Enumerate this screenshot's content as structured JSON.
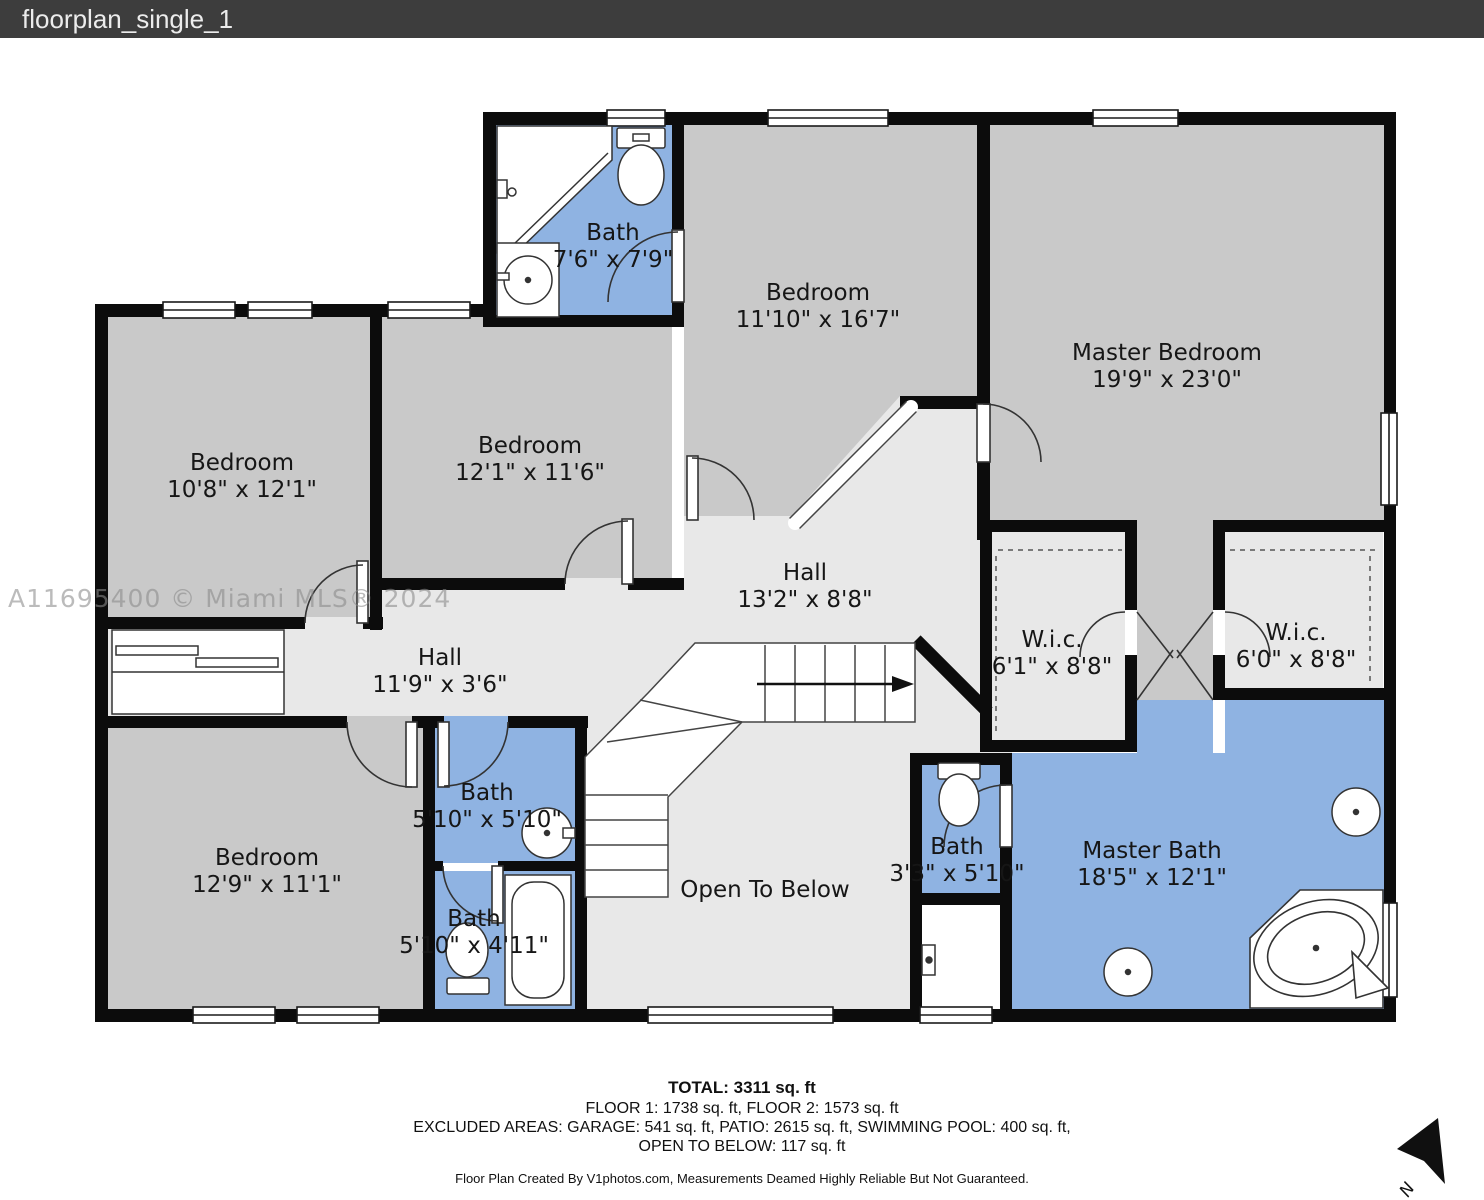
{
  "header": {
    "title": "floorplan_single_1"
  },
  "watermark": "A11695400 © Miami MLS® 2024",
  "rooms": [
    {
      "name": "Bath",
      "dims": "7'6\" x 7'9\""
    },
    {
      "name": "Bedroom",
      "dims": "11'10\" x 16'7\""
    },
    {
      "name": "Master Bedroom",
      "dims": "19'9\" x 23'0\""
    },
    {
      "name": "Bedroom",
      "dims": "10'8\" x 12'1\""
    },
    {
      "name": "Bedroom",
      "dims": "12'1\" x 11'6\""
    },
    {
      "name": "Hall",
      "dims": "13'2\" x 8'8\""
    },
    {
      "name": "W.i.c.",
      "dims": "6'1\" x 8'8\""
    },
    {
      "name": "W.i.c.",
      "dims": "6'0\" x 8'8\""
    },
    {
      "name": "Hall",
      "dims": "11'9\" x 3'6\""
    },
    {
      "name": "Bath",
      "dims": "5'10\" x 5'10\""
    },
    {
      "name": "Bedroom",
      "dims": "12'9\" x 11'1\""
    },
    {
      "name": "Bath",
      "dims": "5'10\" x 4'11\""
    },
    {
      "name": "Open To Below",
      "dims": ""
    },
    {
      "name": "Bath",
      "dims": "3'3\" x 5'10\""
    },
    {
      "name": "Master Bath",
      "dims": "18'5\" x 12'1\""
    }
  ],
  "footer": {
    "total": "TOTAL: 3311 sq. ft",
    "floors": "FLOOR 1: 1738 sq. ft, FLOOR 2: 1573 sq. ft",
    "excluded_line1": "EXCLUDED AREAS: GARAGE: 541 sq. ft, PATIO: 2615 sq. ft, SWIMMING POOL: 400 sq. ft,",
    "excluded_line2": "OPEN TO BELOW: 117 sq. ft",
    "credit": "Floor Plan Created By V1photos.com, Measurements Deamed Highly Reliable But Not Guaranteed."
  },
  "compass": {
    "label": "N"
  },
  "colors": {
    "wall": "#0c0c0c",
    "bedroom_fill": "#c9c9c9",
    "hall_fill": "#e8e8e8",
    "bath_fill": "#8fb3e2",
    "titlebar_bg": "#3d3d3d",
    "titlebar_text": "#ececec"
  }
}
